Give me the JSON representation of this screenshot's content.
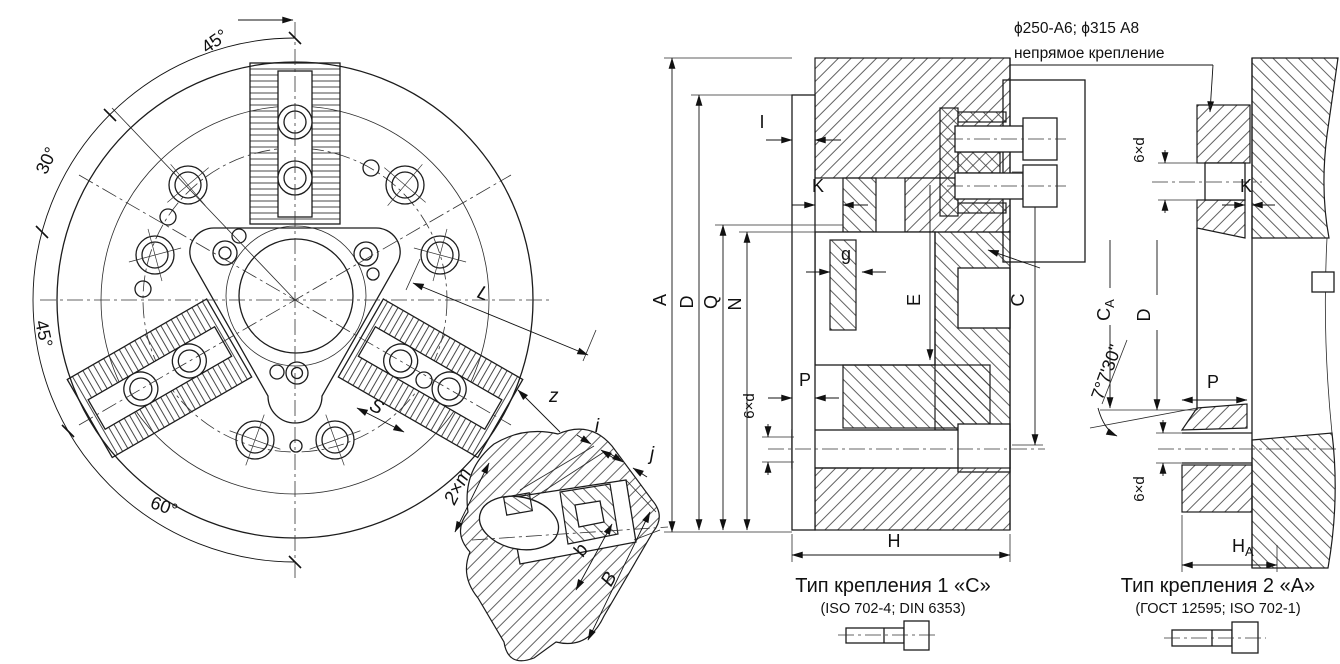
{
  "callout": {
    "spec": "ϕ250-A6; ϕ315 A8",
    "note": "непрямое крепление"
  },
  "front": {
    "angle_top": "45°",
    "angle_upper_left": "30°",
    "angle_left": "45°",
    "angle_bottom": "60°",
    "dim_L": "L",
    "dim_S": "S",
    "dim_z": "z"
  },
  "section1": {
    "dim_A": "A",
    "dim_D": "D",
    "dim_Q": "Q",
    "dim_N": "N",
    "dim_I": "I",
    "dim_K": "K",
    "dim_g": "g",
    "dim_E": "E",
    "dim_C": "C",
    "dim_P": "P",
    "dim_6d": "6×d",
    "dim_H": "H",
    "caption": "Тип крепления 1 «С»",
    "standards": "(ISO 702-4; DIN 6353)"
  },
  "section2": {
    "dim_6d_top": "6×d",
    "dim_K": "K",
    "dim_CA_base": "C",
    "dim_CA_sub": "A",
    "dim_D": "D",
    "angle": "7°7'30\"",
    "dim_P": "P",
    "dim_6d_bottom": "6×d",
    "dim_HA_base": "H",
    "dim_HA_sub": "A",
    "caption": "Тип крепления 2 «А»",
    "standards": "(ГОСТ 12595; ISO 702-1)"
  },
  "detail": {
    "dim_i": "i",
    "dim_j": "j",
    "dim_2m": "2×m",
    "dim_b": "b",
    "dim_B": "B"
  }
}
